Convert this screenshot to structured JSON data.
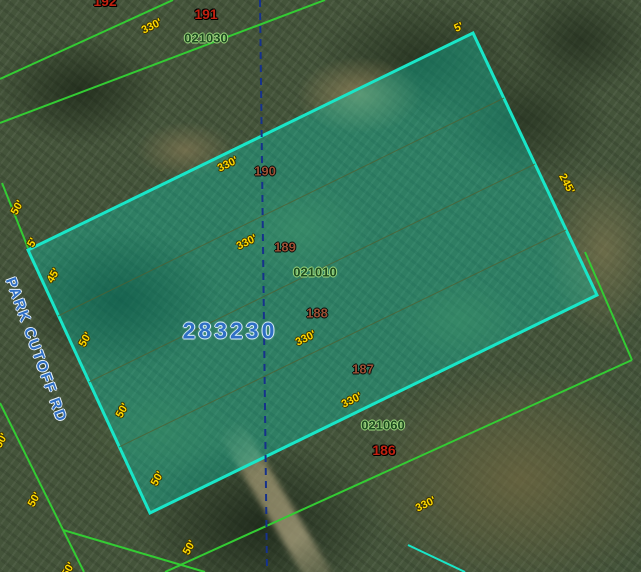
{
  "map": {
    "selected_parcel": {
      "id_label": "283230"
    },
    "road": {
      "name": "PARK CUTOFF RD"
    },
    "colors": {
      "parcel_highlight": "#19e6c8",
      "block_boundary_green": "#33cc33",
      "section_line_blue": "#16328c",
      "lot_number_red": "#c22110",
      "lot_number_inside": "#9b5136",
      "subdivision_green": "#1d4a20",
      "dimension_yellow": "#ffd900",
      "parcel_id_blue": "#2f6fc5"
    },
    "labels": {
      "outside_lot_numbers": [
        {
          "text": "192"
        },
        {
          "text": "191"
        },
        {
          "text": "186"
        }
      ],
      "inside_lot_numbers": [
        {
          "text": "190"
        },
        {
          "text": "189"
        },
        {
          "text": "188"
        },
        {
          "text": "187"
        }
      ],
      "subdivision_numbers": [
        {
          "text": "021030"
        },
        {
          "text": "021010"
        },
        {
          "text": "021060"
        }
      ],
      "dimensions": [
        {
          "text": "330'"
        },
        {
          "text": "330'"
        },
        {
          "text": "330'"
        },
        {
          "text": "330'"
        },
        {
          "text": "330'"
        },
        {
          "text": "330'"
        },
        {
          "text": "245'"
        },
        {
          "text": "5'"
        },
        {
          "text": "50'"
        },
        {
          "text": "5'"
        },
        {
          "text": "45'"
        },
        {
          "text": "50'"
        },
        {
          "text": "50'"
        },
        {
          "text": "50'"
        },
        {
          "text": "50'"
        },
        {
          "text": "50'"
        },
        {
          "text": "50'"
        },
        {
          "text": "50'"
        }
      ]
    }
  }
}
